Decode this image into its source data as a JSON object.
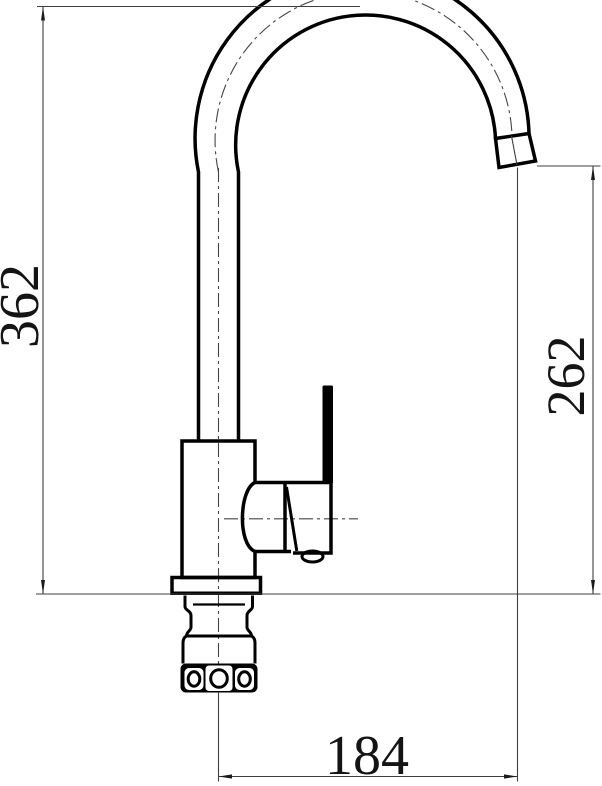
{
  "dimensions": {
    "overall_height": "362",
    "outlet_height": "262",
    "spout_reach": "184"
  },
  "colors": {
    "outline": "#000000",
    "dimension_lines": "#3f3f3f",
    "background": "#ffffff"
  }
}
